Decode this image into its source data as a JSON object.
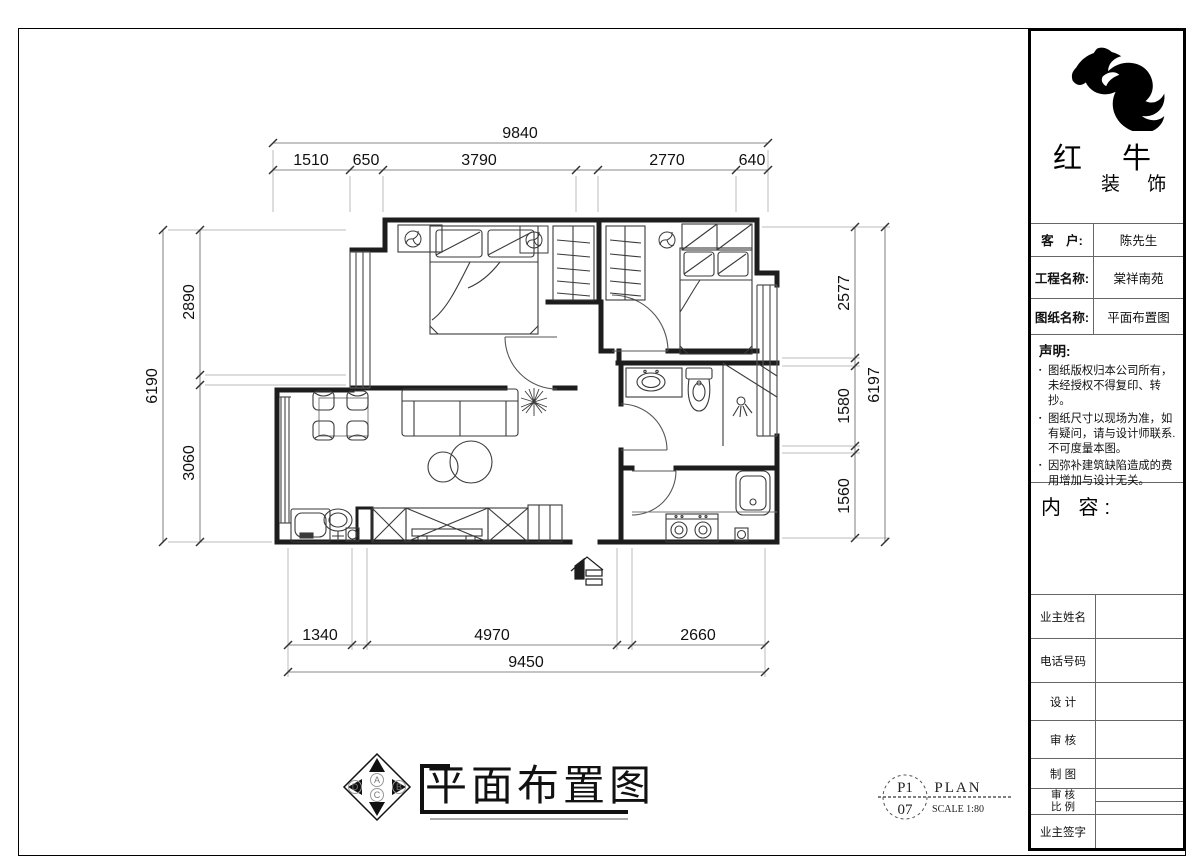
{
  "company": {
    "name": "红 牛",
    "suffix": "装 饰"
  },
  "title_block": {
    "info_rows": [
      {
        "label": "客　户:",
        "value": "陈先生"
      },
      {
        "label": "工程名称:",
        "value": "棠祥南苑"
      },
      {
        "label": "图纸名称:",
        "value": "平面布置图"
      }
    ],
    "declaration": {
      "heading": "声明:",
      "items": [
        "图纸版权归本公司所有，未经授权不得复印、转抄。",
        "图纸尺寸以现场为准，如有疑问，请与设计师联系.不可度量本图。",
        "因弥补建筑缺陷造成的费用增加与设计无关。"
      ]
    },
    "content_heading": "内 容:",
    "sign_rows": [
      {
        "label": "业主姓名"
      },
      {
        "label": "电话号码"
      },
      {
        "label": "设 计"
      },
      {
        "label": "审 核"
      },
      {
        "label": "制 图"
      },
      {
        "label": "审 核",
        "label2": "比 例"
      },
      {
        "label": "业主签字"
      }
    ]
  },
  "drawing": {
    "title": "平面布置图",
    "stamp": {
      "code_top": "P1",
      "code_bottom": "07",
      "name": "PLAN",
      "scale": "SCALE 1:80"
    },
    "compass": {
      "n": "A",
      "e": "B",
      "s": "C",
      "w": "D"
    }
  },
  "dims": {
    "top": {
      "total": "9840",
      "segments": [
        "1510",
        "650",
        "3790",
        "2770",
        "640"
      ]
    },
    "bottom": {
      "total": "9450",
      "segments": [
        "1340",
        "4970",
        "2660"
      ]
    },
    "left": {
      "total": "6190",
      "segments": [
        "2890",
        "3060"
      ]
    },
    "right": {
      "total": "6197",
      "segments": [
        "2577",
        "1580",
        "1560"
      ]
    }
  },
  "colors": {
    "wall": "#1d1d1d",
    "thin": "#444",
    "dim_line": "#8a8a8a",
    "dim_text": "#111"
  }
}
